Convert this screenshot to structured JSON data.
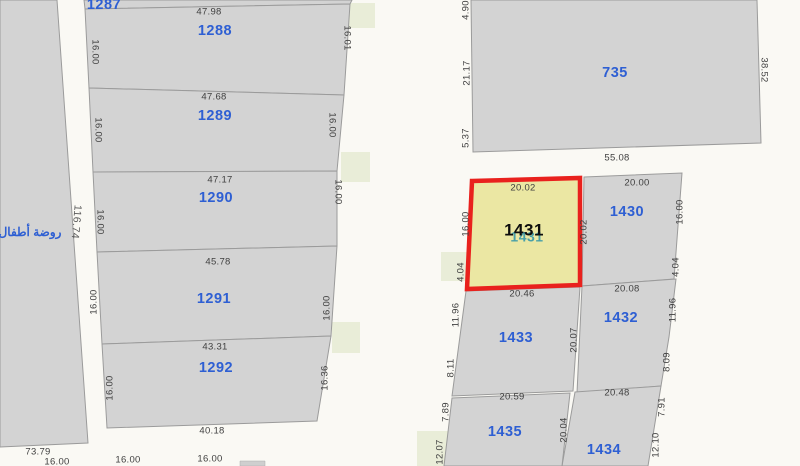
{
  "app": {
    "type": "cadastral-map-viewer",
    "selected_parcel": "1431"
  },
  "colors": {
    "background_road": "#faf9f4",
    "parcel_fill": "#d3d3d3",
    "parcel_border": "#9b9b9b",
    "selected_fill": "#ebe7a3",
    "selected_border": "#e9211d",
    "green_block_fill": "#e9edd8",
    "parcel_number_blue": "#2e5fd3",
    "selected_number_black": "#0d0d0d",
    "shadow_number_teal": "#49a0a8",
    "dimension_text": "#3f3f3f"
  },
  "map": {
    "annotations": [
      {
        "text": "روضة أطفال",
        "x": 30,
        "y": 233
      }
    ],
    "selected": {
      "number": "1431",
      "points": "472,181 580,178 580,285 467,289",
      "lx": 524,
      "ly": 231,
      "shadow_number": "1431",
      "shadow_lx": 527,
      "shadow_ly": 238
    },
    "west_parcel": {
      "points": "0,0 57,0 88,443 0,447"
    },
    "parcels": [
      {
        "number": "1287",
        "points": "84,0 352,0 350,4 85,9",
        "lx": 104,
        "ly": 5
      },
      {
        "number": "1288",
        "points": "85,9 350,4 344,95 89,88",
        "lx": 215,
        "ly": 31
      },
      {
        "number": "1289",
        "points": "89,88 344,95 337,171 93,172",
        "lx": 215,
        "ly": 116
      },
      {
        "number": "1290",
        "points": "93,172 337,171 337,246 97,252",
        "lx": 216,
        "ly": 198
      },
      {
        "number": "1291",
        "points": "97,252 337,246 331,336 102,344",
        "lx": 214,
        "ly": 299
      },
      {
        "number": "1292",
        "points": "102,344 331,336 317,421 107,428",
        "lx": 216,
        "ly": 368
      },
      {
        "number": "735",
        "points": "471,0 757,0 761,143 473,152",
        "lx": 615,
        "ly": 73
      },
      {
        "number": "1430",
        "points": "584,177 682,173 674,279 582,286",
        "lx": 627,
        "ly": 212
      },
      {
        "number": "1432",
        "points": "582,286 676,279 669,337 661,386 577,393",
        "lx": 621,
        "ly": 318
      },
      {
        "number": "1433",
        "points": "466,291 580,287 573,391 452,396",
        "lx": 516,
        "ly": 338
      },
      {
        "number": "1434",
        "points": "575,392 661,386 648,466 562,466",
        "lx": 604,
        "ly": 450
      },
      {
        "number": "1435",
        "points": "452,398 570,393 562,466 444,466",
        "lx": 505,
        "ly": 432
      }
    ],
    "green_blocks": [
      {
        "points": "338,3 375,3 375,28 338,28"
      },
      {
        "points": "341,152 370,152 370,182 341,182"
      },
      {
        "points": "332,322 360,322 360,353 332,353"
      },
      {
        "points": "441,252 469,252 469,281 441,281"
      },
      {
        "points": "417,431 452,431 452,466 417,466"
      }
    ],
    "gray_slivers": [
      {
        "points": "240,461 265,461 265,466 240,466"
      }
    ],
    "dimension_labels": [
      {
        "text": "47.98",
        "x": 209,
        "y": 12,
        "rot": 0,
        "big": false
      },
      {
        "text": "47.68",
        "x": 214,
        "y": 97,
        "rot": 0,
        "big": false
      },
      {
        "text": "47.17",
        "x": 220,
        "y": 180,
        "rot": 0,
        "big": false
      },
      {
        "text": "45.78",
        "x": 218,
        "y": 262,
        "rot": 0,
        "big": false
      },
      {
        "text": "43.31",
        "x": 215,
        "y": 347,
        "rot": 0,
        "big": false
      },
      {
        "text": "40.18",
        "x": 212,
        "y": 431,
        "rot": 0,
        "big": false
      },
      {
        "text": "73.79",
        "x": 38,
        "y": 452,
        "rot": 0,
        "big": false
      },
      {
        "text": "16.00",
        "x": 57,
        "y": 462,
        "rot": 0,
        "big": false
      },
      {
        "text": "16.00",
        "x": 128,
        "y": 460,
        "rot": 0,
        "big": false
      },
      {
        "text": "16.00",
        "x": 210,
        "y": 459,
        "rot": 0,
        "big": false
      },
      {
        "text": "55.08",
        "x": 617,
        "y": 158,
        "rot": 0,
        "big": false
      },
      {
        "text": "20.00",
        "x": 637,
        "y": 183,
        "rot": 0,
        "big": false
      },
      {
        "text": "20.02",
        "x": 523,
        "y": 188,
        "rot": 0,
        "big": false
      },
      {
        "text": "20.46",
        "x": 522,
        "y": 294,
        "rot": 0,
        "big": false
      },
      {
        "text": "20.08",
        "x": 627,
        "y": 289,
        "rot": 0,
        "big": false
      },
      {
        "text": "20.59",
        "x": 512,
        "y": 397,
        "rot": 0,
        "big": false
      },
      {
        "text": "20.48",
        "x": 617,
        "y": 393,
        "rot": 0,
        "big": false
      },
      {
        "text": "116.74",
        "x": 76,
        "y": 222,
        "rot": 95,
        "big": true
      },
      {
        "text": "16.00",
        "x": 95,
        "y": 52,
        "rot": 90,
        "big": false
      },
      {
        "text": "16.00",
        "x": 98,
        "y": 130,
        "rot": 90,
        "big": false
      },
      {
        "text": "16.00",
        "x": 100,
        "y": 222,
        "rot": 90,
        "big": false
      },
      {
        "text": "16.00",
        "x": 94,
        "y": 302,
        "rot": -90,
        "big": false
      },
      {
        "text": "16.00",
        "x": 110,
        "y": 388,
        "rot": -90,
        "big": false
      },
      {
        "text": "16.01",
        "x": 347,
        "y": 38,
        "rot": 90,
        "big": false
      },
      {
        "text": "16.00",
        "x": 332,
        "y": 125,
        "rot": 90,
        "big": false
      },
      {
        "text": "16.00",
        "x": 338,
        "y": 192,
        "rot": 90,
        "big": false
      },
      {
        "text": "16.00",
        "x": 327,
        "y": 308,
        "rot": -90,
        "big": false
      },
      {
        "text": "16.36",
        "x": 325,
        "y": 378,
        "rot": -90,
        "big": false
      },
      {
        "text": "4.90",
        "x": 466,
        "y": 10,
        "rot": -90,
        "big": false
      },
      {
        "text": "21.17",
        "x": 467,
        "y": 73,
        "rot": -90,
        "big": false
      },
      {
        "text": "5.37",
        "x": 466,
        "y": 138,
        "rot": -90,
        "big": false
      },
      {
        "text": "38.52",
        "x": 764,
        "y": 70,
        "rot": 90,
        "big": false
      },
      {
        "text": "16.00",
        "x": 466,
        "y": 224,
        "rot": -90,
        "big": false
      },
      {
        "text": "4.04",
        "x": 461,
        "y": 272,
        "rot": -90,
        "big": false
      },
      {
        "text": "20.02",
        "x": 584,
        "y": 232,
        "rot": -90,
        "big": false
      },
      {
        "text": "16.00",
        "x": 680,
        "y": 212,
        "rot": -90,
        "big": false
      },
      {
        "text": "4.04",
        "x": 676,
        "y": 267,
        "rot": -90,
        "big": false
      },
      {
        "text": "11.96",
        "x": 673,
        "y": 310,
        "rot": -90,
        "big": false
      },
      {
        "text": "8.09",
        "x": 667,
        "y": 362,
        "rot": -90,
        "big": false
      },
      {
        "text": "11.96",
        "x": 456,
        "y": 315,
        "rot": -90,
        "big": false
      },
      {
        "text": "8.11",
        "x": 451,
        "y": 368,
        "rot": -90,
        "big": false
      },
      {
        "text": "20.07",
        "x": 574,
        "y": 340,
        "rot": -90,
        "big": false
      },
      {
        "text": "20.04",
        "x": 564,
        "y": 430,
        "rot": -90,
        "big": false
      },
      {
        "text": "7.89",
        "x": 446,
        "y": 412,
        "rot": -90,
        "big": false
      },
      {
        "text": "12.07",
        "x": 440,
        "y": 452,
        "rot": -90,
        "big": false
      },
      {
        "text": "7.91",
        "x": 662,
        "y": 407,
        "rot": -90,
        "big": false
      },
      {
        "text": "12.10",
        "x": 656,
        "y": 445,
        "rot": -90,
        "big": false
      }
    ]
  }
}
